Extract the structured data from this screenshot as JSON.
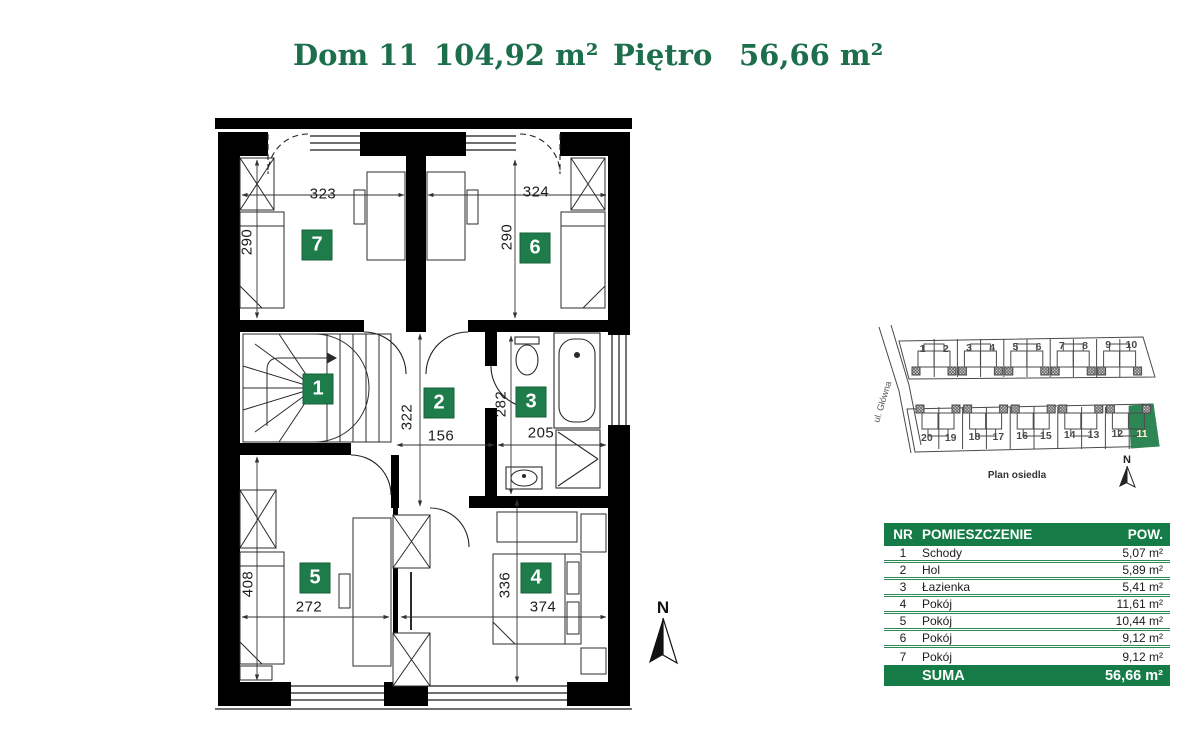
{
  "header": {
    "house": "Dom 11",
    "total_area": "104,92 m²",
    "floor": "Piętro",
    "floor_area": "56,66 m²"
  },
  "plan": {
    "badges": [
      {
        "number": "1"
      },
      {
        "number": "2"
      },
      {
        "number": "3"
      },
      {
        "number": "4"
      },
      {
        "number": "5"
      },
      {
        "number": "6"
      },
      {
        "number": "7"
      }
    ],
    "dimensions": [
      {
        "room": "pokoj-7",
        "label": "323"
      },
      {
        "room": "pokoj-7",
        "label": "290"
      },
      {
        "room": "pokoj-6",
        "label": "324"
      },
      {
        "room": "pokoj-6",
        "label": "290"
      },
      {
        "room": "hol",
        "label": "322"
      },
      {
        "room": "hol",
        "label": "156"
      },
      {
        "room": "lazienka",
        "label": "282"
      },
      {
        "room": "lazienka",
        "label": "205"
      },
      {
        "room": "pokoj-5",
        "label": "408"
      },
      {
        "room": "pokoj-5",
        "label": "272"
      },
      {
        "room": "pokoj-4",
        "label": "336"
      },
      {
        "room": "pokoj-4",
        "label": "374"
      }
    ],
    "compass_label": "N"
  },
  "site_plan": {
    "street": "ul. Główna",
    "caption": "Plan osiedla",
    "compass_label": "N",
    "top_row": [
      "1",
      "2",
      "3",
      "4",
      "5",
      "6",
      "7",
      "8",
      "9",
      "10"
    ],
    "bottom_row": [
      "20",
      "19",
      "18",
      "17",
      "16",
      "15",
      "14",
      "13",
      "12",
      "11"
    ],
    "highlighted_unit": "11",
    "highlight_color": "#2e8654"
  },
  "table": {
    "headers": {
      "nr": "NR",
      "room": "POMIESZCZENIE",
      "area": "POW."
    },
    "rows": [
      {
        "nr": "1",
        "room": "Schody",
        "area": "5,07 m²"
      },
      {
        "nr": "2",
        "room": "Hol",
        "area": "5,89 m²"
      },
      {
        "nr": "3",
        "room": "Łazienka",
        "area": "5,41 m²"
      },
      {
        "nr": "4",
        "room": "Pokój",
        "area": "11,61 m²"
      },
      {
        "nr": "5",
        "room": "Pokój",
        "area": "10,44 m²"
      },
      {
        "nr": "6",
        "room": "Pokój",
        "area": "9,12 m²"
      },
      {
        "nr": "7",
        "room": "Pokój",
        "area": "9,12 m²"
      }
    ],
    "total_label": "SUMA",
    "total_area": "56,66 m²"
  },
  "colors": {
    "accent_green": "#157c47",
    "badge_green": "#1e7c4a",
    "title_green": "#1d6f4c",
    "highlight_green": "#2e8654"
  }
}
